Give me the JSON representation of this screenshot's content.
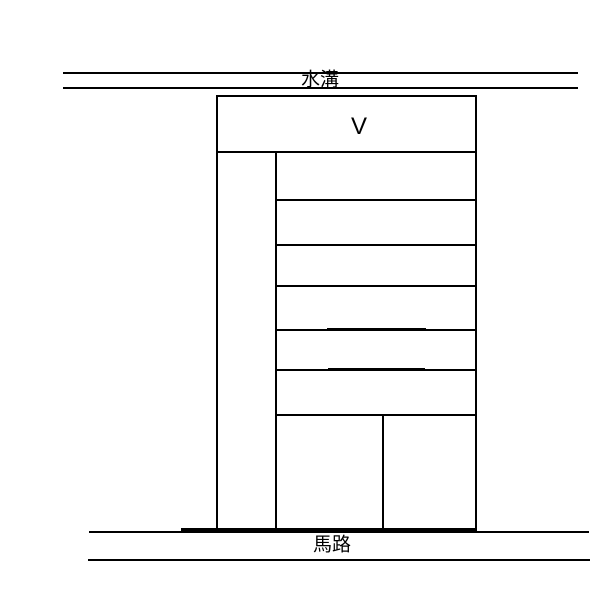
{
  "diagram": {
    "title": "building-site-sketch",
    "background_color": "#ffffff",
    "line_color": "#000000",
    "labels": {
      "ditch": "水溝",
      "unit": "V",
      "road": "馬路"
    },
    "geometry": {
      "lines": [
        {
          "name": "ditch-line-top",
          "x": 63,
          "y": 72,
          "w": 515,
          "h": 2
        },
        {
          "name": "ditch-line-bottom",
          "x": 63,
          "y": 87,
          "w": 515,
          "h": 2
        },
        {
          "name": "building-top-edge",
          "x": 216,
          "y": 95,
          "w": 261,
          "h": 2
        },
        {
          "name": "building-left-wall",
          "x": 216,
          "y": 95,
          "w": 2,
          "h": 435
        },
        {
          "name": "building-right-wall",
          "x": 475,
          "y": 95,
          "w": 2,
          "h": 435
        },
        {
          "name": "unit-section-bottom",
          "x": 216,
          "y": 151,
          "w": 261,
          "h": 2
        },
        {
          "name": "inner-vertical-wall",
          "x": 275,
          "y": 151,
          "w": 2,
          "h": 379
        },
        {
          "name": "floor-line-1",
          "x": 276,
          "y": 199,
          "w": 201,
          "h": 2
        },
        {
          "name": "floor-line-2",
          "x": 276,
          "y": 244,
          "w": 201,
          "h": 2
        },
        {
          "name": "floor-line-3",
          "x": 276,
          "y": 285,
          "w": 201,
          "h": 2
        },
        {
          "name": "floor-line-4",
          "x": 276,
          "y": 329,
          "w": 201,
          "h": 2
        },
        {
          "name": "floor-line-4-thick-seg",
          "x": 327,
          "y": 328,
          "w": 99,
          "h": 3
        },
        {
          "name": "floor-line-5",
          "x": 276,
          "y": 369,
          "w": 201,
          "h": 2
        },
        {
          "name": "floor-line-5-thick-seg",
          "x": 328,
          "y": 368,
          "w": 97,
          "h": 3
        },
        {
          "name": "floor-line-6",
          "x": 276,
          "y": 414,
          "w": 201,
          "h": 2
        },
        {
          "name": "ground-floor-partition",
          "x": 382,
          "y": 414,
          "w": 2,
          "h": 116
        },
        {
          "name": "building-base-line",
          "x": 181,
          "y": 528,
          "w": 296,
          "h": 3
        },
        {
          "name": "road-line-top",
          "x": 89,
          "y": 531,
          "w": 500,
          "h": 2
        },
        {
          "name": "road-line-bottom",
          "x": 88,
          "y": 559,
          "w": 502,
          "h": 2
        }
      ]
    }
  }
}
